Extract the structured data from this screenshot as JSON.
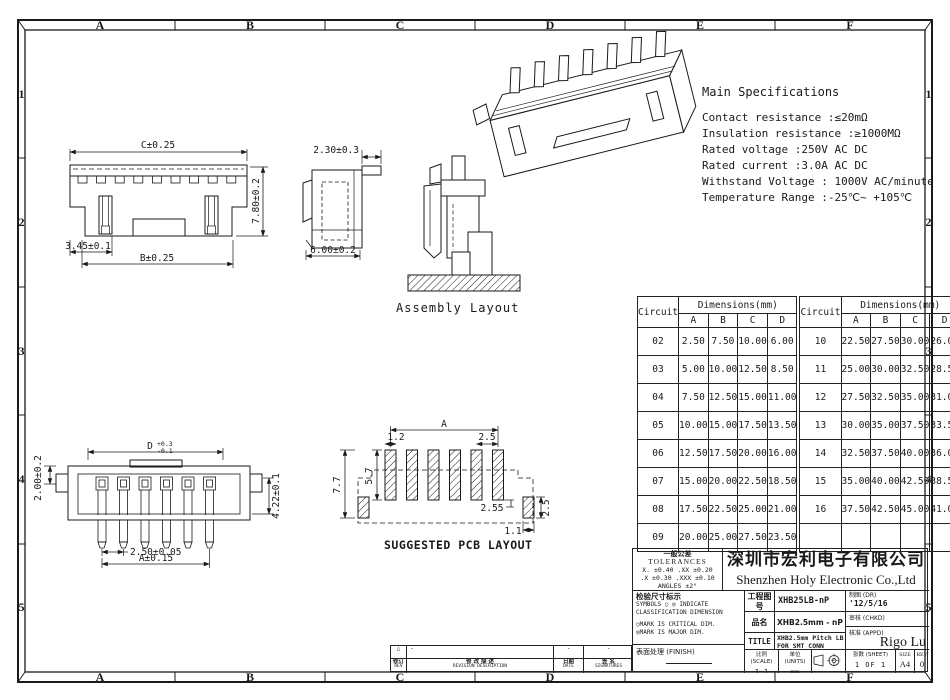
{
  "frame": {
    "cols": [
      "A",
      "B",
      "C",
      "D",
      "E",
      "F"
    ],
    "rows": [
      "1",
      "2",
      "3",
      "4",
      "5"
    ]
  },
  "specs": {
    "title": "Main Specifications",
    "lines": [
      "Contact resistance :≤20mΩ",
      "Insulation resistance :≥1000MΩ",
      "Rated voltage :250V AC DC",
      "Rated current :3.0A AC DC",
      "Withstand Voltage : 1000V AC/minute",
      "Temperature Range  :-25℃~ +105℃"
    ]
  },
  "views": {
    "front": {
      "c": "C±0.25",
      "h": "7.80±0.2",
      "p": "3.45±0.1",
      "b": "B±0.25"
    },
    "side": {
      "t": "2.30±0.3",
      "w": "6.00±0.2"
    },
    "assembly": {
      "label": "Assembly Layout"
    },
    "smt": {
      "h": "2.00±0.2",
      "d": "D",
      "dp": "+0.3",
      "dm": "-0.1",
      "r": "4.22±0.1",
      "pitch": "2.50±0.05",
      "a": "A±0.15"
    },
    "pcb": {
      "label": "SUGGESTED PCB LAYOUT",
      "a": "A",
      "w12": "1.2",
      "p25": "2.5",
      "h57": "5.7",
      "h77": "7.7",
      "d255": "2.55",
      "r25": "2.5",
      "w11": "1.1"
    }
  },
  "table": {
    "circuit": "Circuit",
    "dims": "Dimensions(mm)",
    "cols": [
      "A",
      "B",
      "C",
      "D"
    ],
    "left": [
      [
        "02",
        "2.50",
        "7.50",
        "10.00",
        "6.00"
      ],
      [
        "03",
        "5.00",
        "10.00",
        "12.50",
        "8.50"
      ],
      [
        "04",
        "7.50",
        "12.50",
        "15.00",
        "11.00"
      ],
      [
        "05",
        "10.00",
        "15.00",
        "17.50",
        "13.50"
      ],
      [
        "06",
        "12.50",
        "17.50",
        "20.00",
        "16.00"
      ],
      [
        "07",
        "15.00",
        "20.00",
        "22.50",
        "18.50"
      ],
      [
        "08",
        "17.50",
        "22.50",
        "25.00",
        "21.00"
      ],
      [
        "09",
        "20.00",
        "25.00",
        "27.50",
        "23.50"
      ]
    ],
    "right": [
      [
        "10",
        "22.50",
        "27.50",
        "30.00",
        "26.00"
      ],
      [
        "11",
        "25.00",
        "30.00",
        "32.50",
        "28.50"
      ],
      [
        "12",
        "27.50",
        "32.50",
        "35.00",
        "31.00"
      ],
      [
        "13",
        "30.00",
        "35.00",
        "37.50",
        "33.50"
      ],
      [
        "14",
        "32.50",
        "37.50",
        "40.00",
        "36.00"
      ],
      [
        "15",
        "35.00",
        "40.00",
        "42.50",
        "38.50"
      ],
      [
        "16",
        "37.50",
        "42.50",
        "45.00",
        "41.00"
      ],
      [
        "",
        "",
        "",
        "",
        ""
      ]
    ]
  },
  "titleblock": {
    "tol_cn": "一般公差",
    "tol_en": "TOLERANCES",
    "tol1": "X. ±0.40   .XX ±0.20",
    "tol2": ".X ±0.30   .XXX ±0.10",
    "tol3": "ANGLES    ±2°",
    "company_cn": "深圳市宏利电子有限公司",
    "company_en": "Shenzhen Holy Electronic Co.,Ltd",
    "insp_title": "检验尺寸标示",
    "insp1": "SYMBOLS ○ ◎ INDICATE",
    "insp2": "CLASSIFICATION DIMENSION",
    "insp3": "○MARK IS CRITICAL DIM.",
    "insp4": "◎MARK IS MAJOR DIM.",
    "finish_label": "表面处理 (FINISH)",
    "eng_label": "工程图号",
    "eng_no": "XHB25LB-nP",
    "part_label": "品名",
    "part_name": "XHB2.5mm - nP 立贴带扣",
    "title_label": "TITLE",
    "title_value": "XHB2.5mm Pitch LB FOR SMT CONN",
    "scale_label": "比例 (SCALE)",
    "scale": "1:1",
    "units_label": "单位 (UNITS)",
    "units": "mm",
    "dr_label": "制图 (DR)",
    "dr_date": "'12/5/16",
    "chkd_label": "审核 (CHKD)",
    "appd_label": "核准 (APPD)",
    "appd_name": "Rigo Lu",
    "sheet_label": "张数 (SHEET)",
    "sheet": "1 OF 1",
    "size_label": "SIZE",
    "size": "A4",
    "rev_label": "REV",
    "rev": "0"
  },
  "revision": {
    "warn": "△",
    "d1": "-",
    "d2": "-",
    "d3": "-",
    "rev_cn": "修订",
    "rev_en": "REV",
    "desc_cn": "修 改 描 述",
    "desc_en": "REVISION DESCRIPTION",
    "date_cn": "日期",
    "date_en": "DATE",
    "sign_cn": "签 名",
    "sign_en": "SIGNATURES"
  }
}
